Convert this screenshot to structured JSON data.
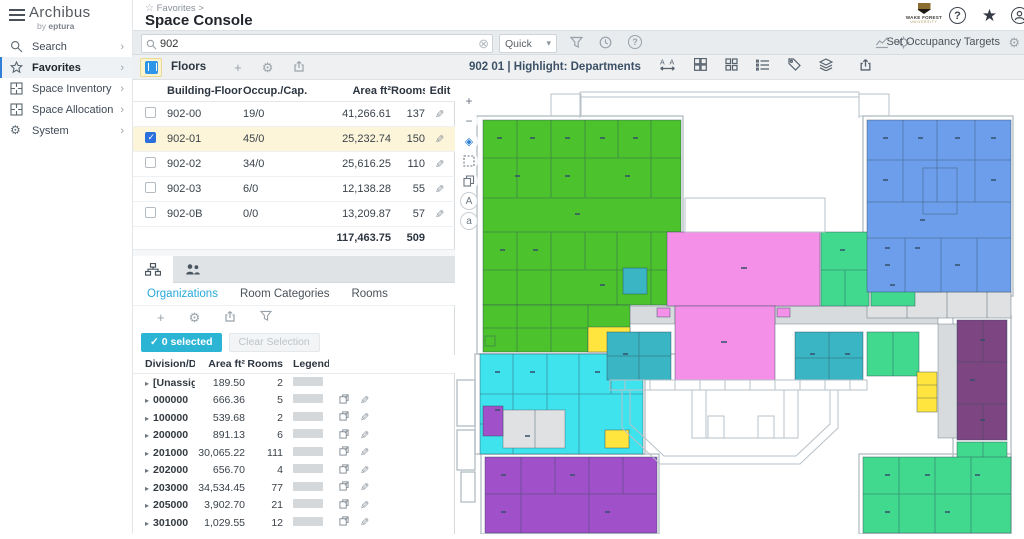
{
  "ui_colors": {
    "accent": "#2bb4d4",
    "row_highlight": "#fdf5d9",
    "check_blue": "#2a6fdb",
    "link_blue": "#29a8d8"
  },
  "sidebar": {
    "brand": "Archibus",
    "brand_sub_prefix": "by",
    "brand_sub": "eptura",
    "items": [
      {
        "label": "Search"
      },
      {
        "label": "Favorites"
      },
      {
        "label": "Space Inventory"
      },
      {
        "label": "Space Allocation"
      },
      {
        "label": "System"
      }
    ],
    "chevron": "›"
  },
  "header": {
    "breadcrumb": "Favorites >",
    "title": "Space Console",
    "org_logo_line1": "WAKE FOREST",
    "org_logo_line2": "UNIVERSITY",
    "help_glyph": "?"
  },
  "toolbar": {
    "search_value": "902",
    "quick_label": "Quick",
    "set_occupancy_targets": "Set Occupancy Targets"
  },
  "floors_panel": {
    "title": "Floors",
    "columns": {
      "building_floor": "Building-Floor",
      "occup_cap": "Occup./Cap.",
      "area": "Area ft²",
      "rooms": "Rooms",
      "edit": "Edit"
    },
    "rows": [
      {
        "building_floor": "902-00",
        "occup_cap": "19/0",
        "area": "41,266.61",
        "rooms": "137",
        "selected": false
      },
      {
        "building_floor": "902-01",
        "occup_cap": "45/0",
        "area": "25,232.74",
        "rooms": "150",
        "selected": true
      },
      {
        "building_floor": "902-02",
        "occup_cap": "34/0",
        "area": "25,616.25",
        "rooms": "110",
        "selected": false
      },
      {
        "building_floor": "902-03",
        "occup_cap": "6/0",
        "area": "12,138.28",
        "rooms": "55",
        "selected": false
      },
      {
        "building_floor": "902-0B",
        "occup_cap": "0/0",
        "area": "13,209.87",
        "rooms": "57",
        "selected": false
      }
    ],
    "total_area": "117,463.75",
    "total_rooms": "509"
  },
  "org_panel": {
    "tabs": [
      "Organizations",
      "Room Categories",
      "Rooms"
    ],
    "active_tab": "Organizations",
    "selected_button": "0 selected",
    "clear_button": "Clear Selection",
    "columns": {
      "code": "Division/Department",
      "area": "Area ft²",
      "rooms": "Rooms",
      "legend": "Legend"
    },
    "rows": [
      {
        "code": "[Unassigned]",
        "area": "189.50",
        "rooms": "2",
        "unassigned": true
      },
      {
        "code": "000000",
        "area": "666.36",
        "rooms": "5"
      },
      {
        "code": "100000",
        "area": "539.68",
        "rooms": "2"
      },
      {
        "code": "200000",
        "area": "891.13",
        "rooms": "6"
      },
      {
        "code": "201000",
        "area": "30,065.22",
        "rooms": "111"
      },
      {
        "code": "202000",
        "area": "656.70",
        "rooms": "4"
      },
      {
        "code": "203000",
        "area": "34,534.45",
        "rooms": "77"
      },
      {
        "code": "205000",
        "area": "3,902.70",
        "rooms": "21"
      },
      {
        "code": "301000",
        "area": "1,029.55",
        "rooms": "12"
      }
    ]
  },
  "plan_panel": {
    "title": "902 01 | Highlight: Departments",
    "colors": {
      "green": "#4cc32d",
      "blue": "#6d9eeb",
      "pink": "#f490e7",
      "cyan": "#3fe3ed",
      "teal": "#3ab5c4",
      "spring": "#41d98e",
      "violet": "#a050c8",
      "plum": "#7e4583",
      "yellow": "#ffe53d",
      "darkgreen": "#2f9e2f"
    }
  },
  "icons": {
    "plus": "+",
    "minus": "−",
    "fit": "◈",
    "upper_a": "A",
    "lower_a": "a",
    "gear": "⚙",
    "pencil": "✎",
    "clear": "⊗",
    "star_filled": "★",
    "star_outline": "☆",
    "check": "✓",
    "caret": "▸",
    "dots": "• • • • •",
    "dd_chevron": "▾"
  }
}
